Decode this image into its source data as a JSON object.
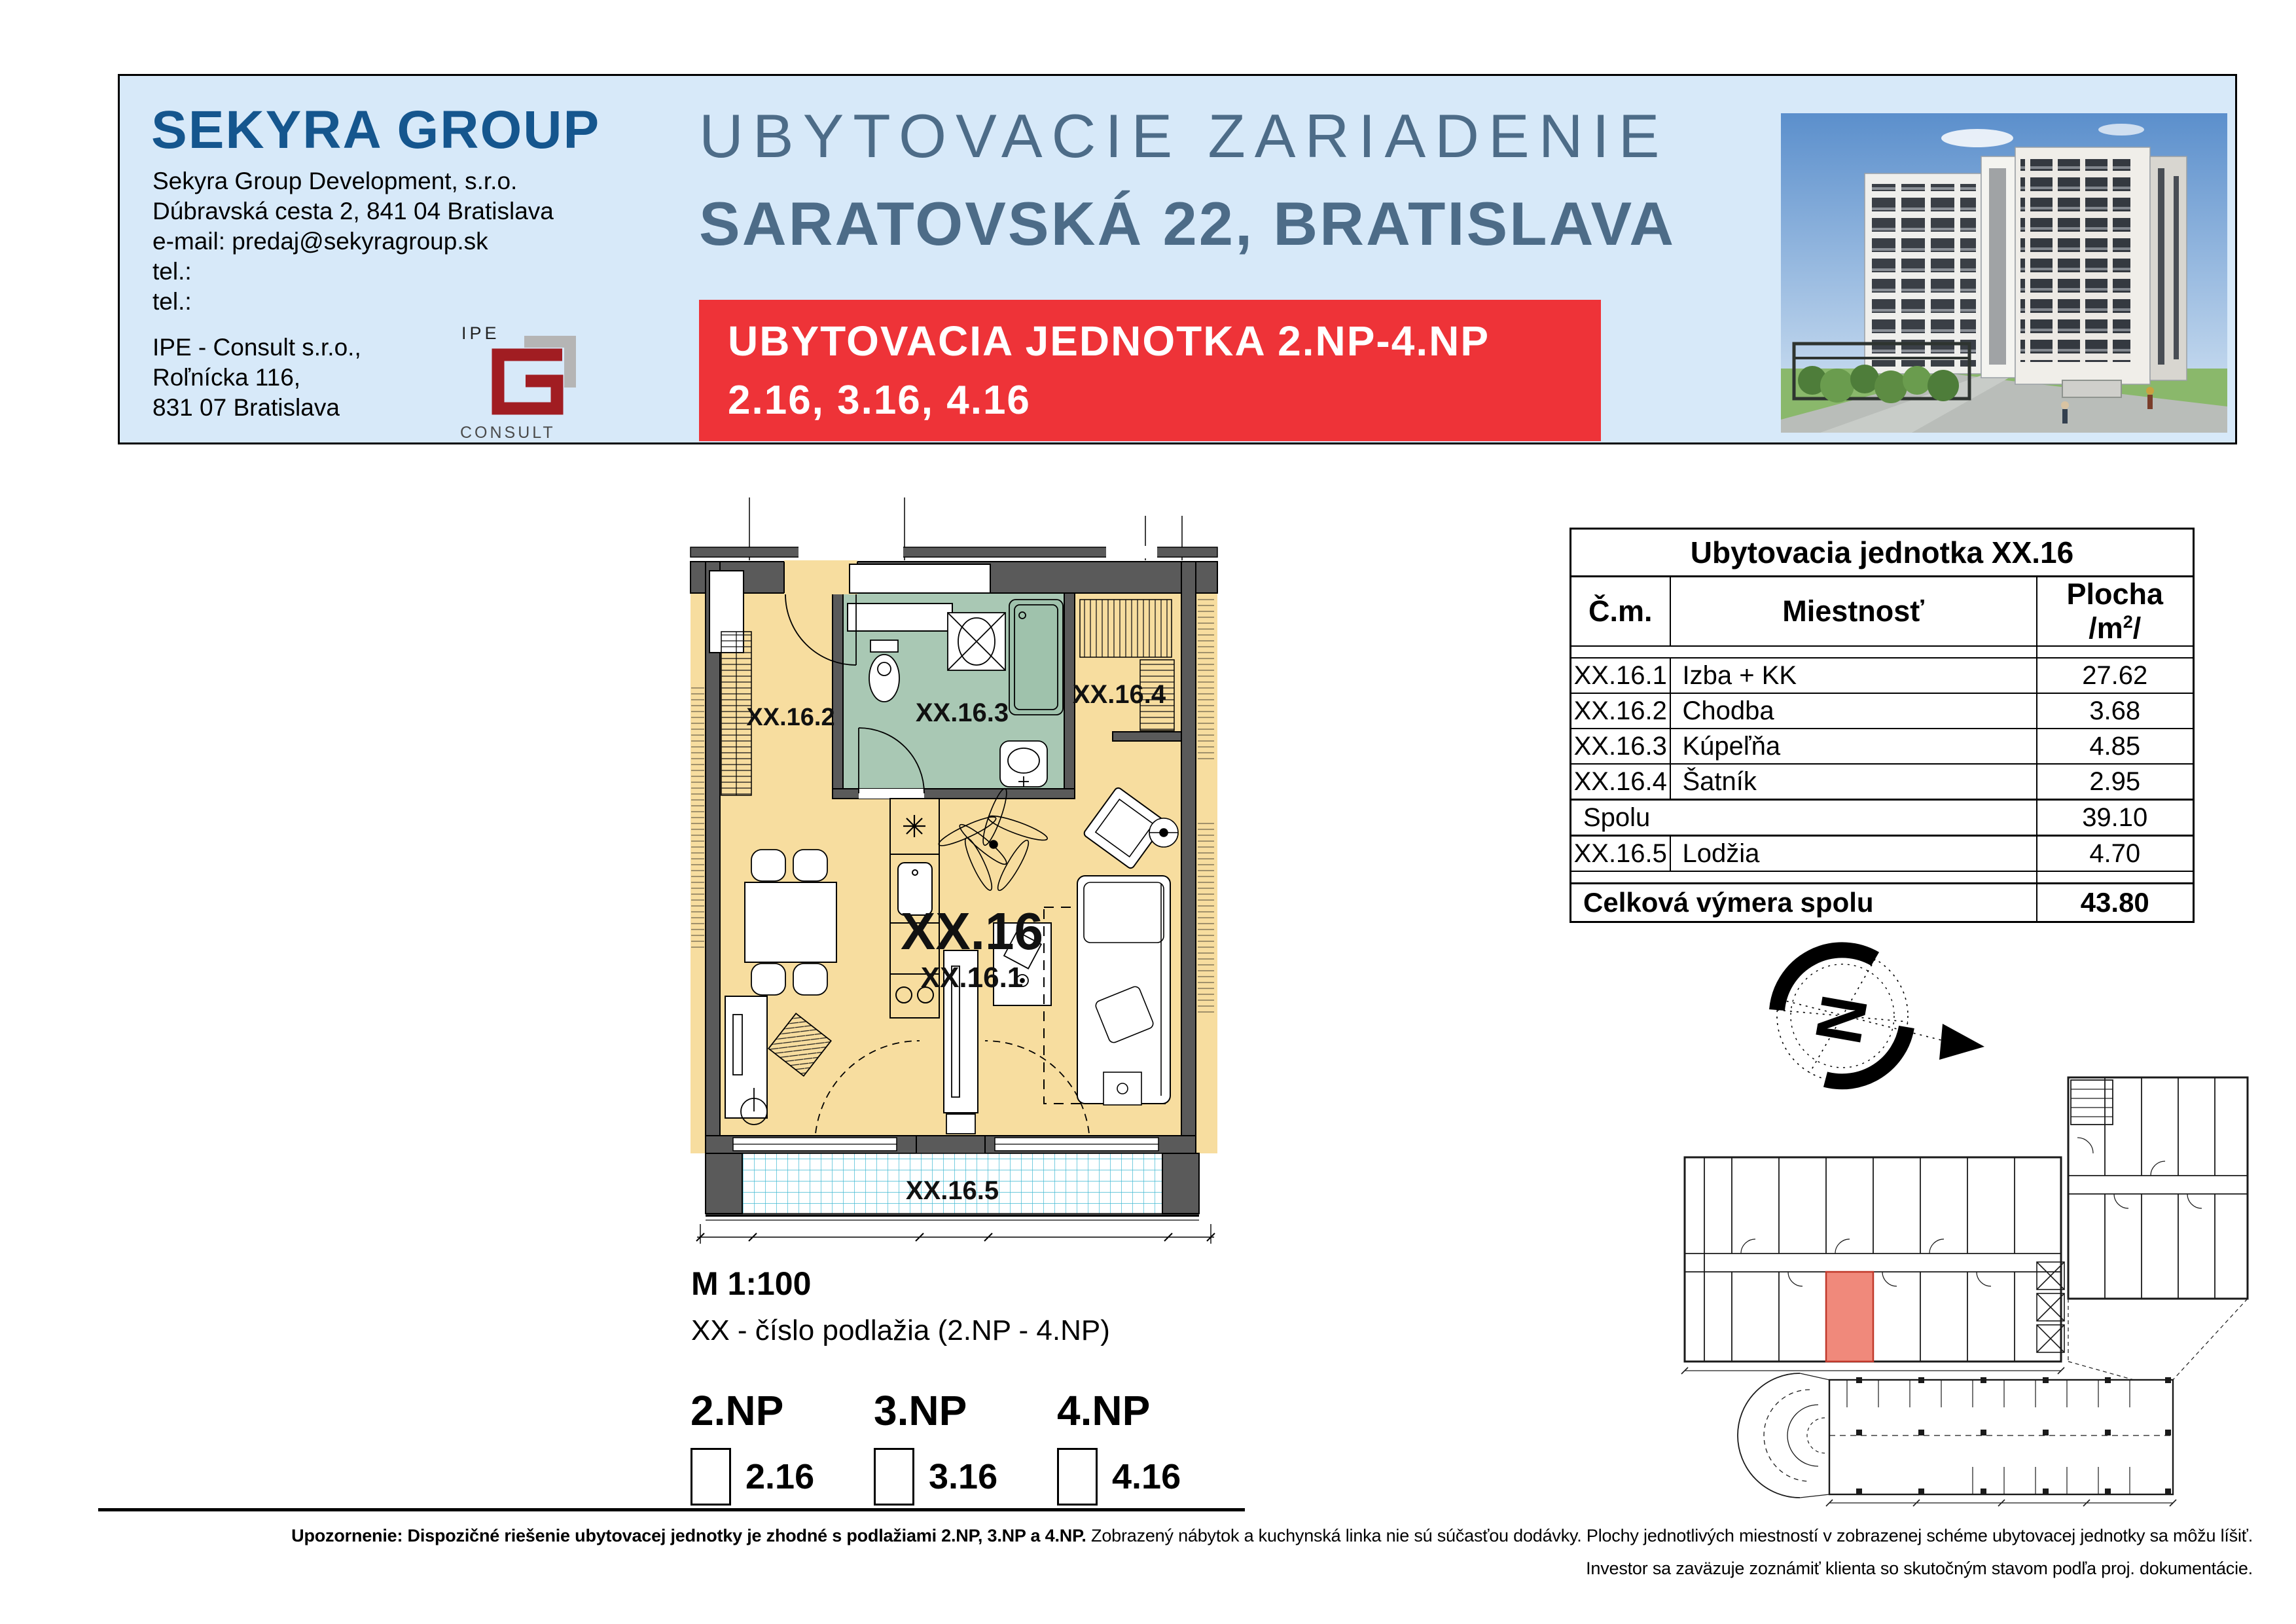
{
  "header": {
    "logo_text": "SEKYRA GROUP",
    "company_lines": [
      "Sekyra Group Development, s.r.o.",
      "Dúbravská cesta 2, 841 04 Bratislava",
      "e-mail: predaj@sekyragroup.sk",
      "tel.:",
      "tel.:"
    ],
    "partner_lines": [
      "IPE - Consult s.r.o.,",
      "Roľnícka 116,",
      "831 07 Bratislava"
    ],
    "ipe_logo": {
      "top": "IPE",
      "bottom": "CONSULT"
    },
    "title_line1": "UBYTOVACIE ZARIADENIE",
    "title_line2": "SARATOVSKÁ 22, BRATISLAVA",
    "banner": {
      "label": "UBYTOVACIA JEDNOTKA",
      "floors": "2.NP-4.NP",
      "units": "2.16, 3.16, 4.16"
    }
  },
  "plan": {
    "unit_label": "XX.16",
    "room1": "XX.16.1",
    "room2": "XX.16.2",
    "room3": "XX.16.3",
    "room4": "XX.16.4",
    "room5": "XX.16.5",
    "scale": "M 1:100",
    "note": "XX - číslo podlažia (2.NP - 4.NP)",
    "floors": [
      {
        "label": "2.NP",
        "unit": "2.16"
      },
      {
        "label": "3.NP",
        "unit": "3.16"
      },
      {
        "label": "4.NP",
        "unit": "4.16"
      }
    ]
  },
  "compass": {
    "north": "N"
  },
  "table": {
    "title": "Ubytovacia jednotka XX.16",
    "col_cm": "Č.m.",
    "col_room": "Miestnosť",
    "col_area": "Plocha /m",
    "col_area_sup": "2",
    "col_area_end": "/",
    "rows": [
      {
        "cm": "XX.16.1",
        "room": "Izba + KK",
        "area": "27.62"
      },
      {
        "cm": "XX.16.2",
        "room": "Chodba",
        "area": "3.68"
      },
      {
        "cm": "XX.16.3",
        "room": "Kúpeľňa",
        "area": "4.85"
      },
      {
        "cm": "XX.16.4",
        "room": "Šatník",
        "area": "2.95"
      }
    ],
    "subtotal": {
      "label": "Spolu",
      "area": "39.10"
    },
    "loggia": {
      "cm": "XX.16.5",
      "room": "Lodžia",
      "area": "4.70"
    },
    "total": {
      "label": "Celková výmera spolu",
      "area": "43.80"
    }
  },
  "footer": {
    "bold": "Upozornenie: Dispozičné riešenie ubytovacej jednotky je zhodné s podlažiami 2.NP, 3.NP a 4.NP.",
    "rest": " Zobrazený nábytok a kuchynská linka nie sú súčasťou dodávky. Plochy jednotlivých miestností v zobrazenej schéme ubytovacej jednotky sa môžu líšiť.",
    "line2": "Investor sa zaväzuje zoznámiť klienta so skutočným stavom podľa proj. dokumentácie."
  },
  "colors": {
    "header_bg": "#d7e9f9",
    "banner_red": "#ee3338",
    "title_blue": "#4d6c88",
    "logo_blue": "#15568e",
    "floor_yellow": "#f7dd9f",
    "bath_green": "#a9c8b4",
    "wall_gray": "#5a5a5a",
    "tile_cyan": "#3fb9d2",
    "highlight_red": "#f0897b"
  }
}
